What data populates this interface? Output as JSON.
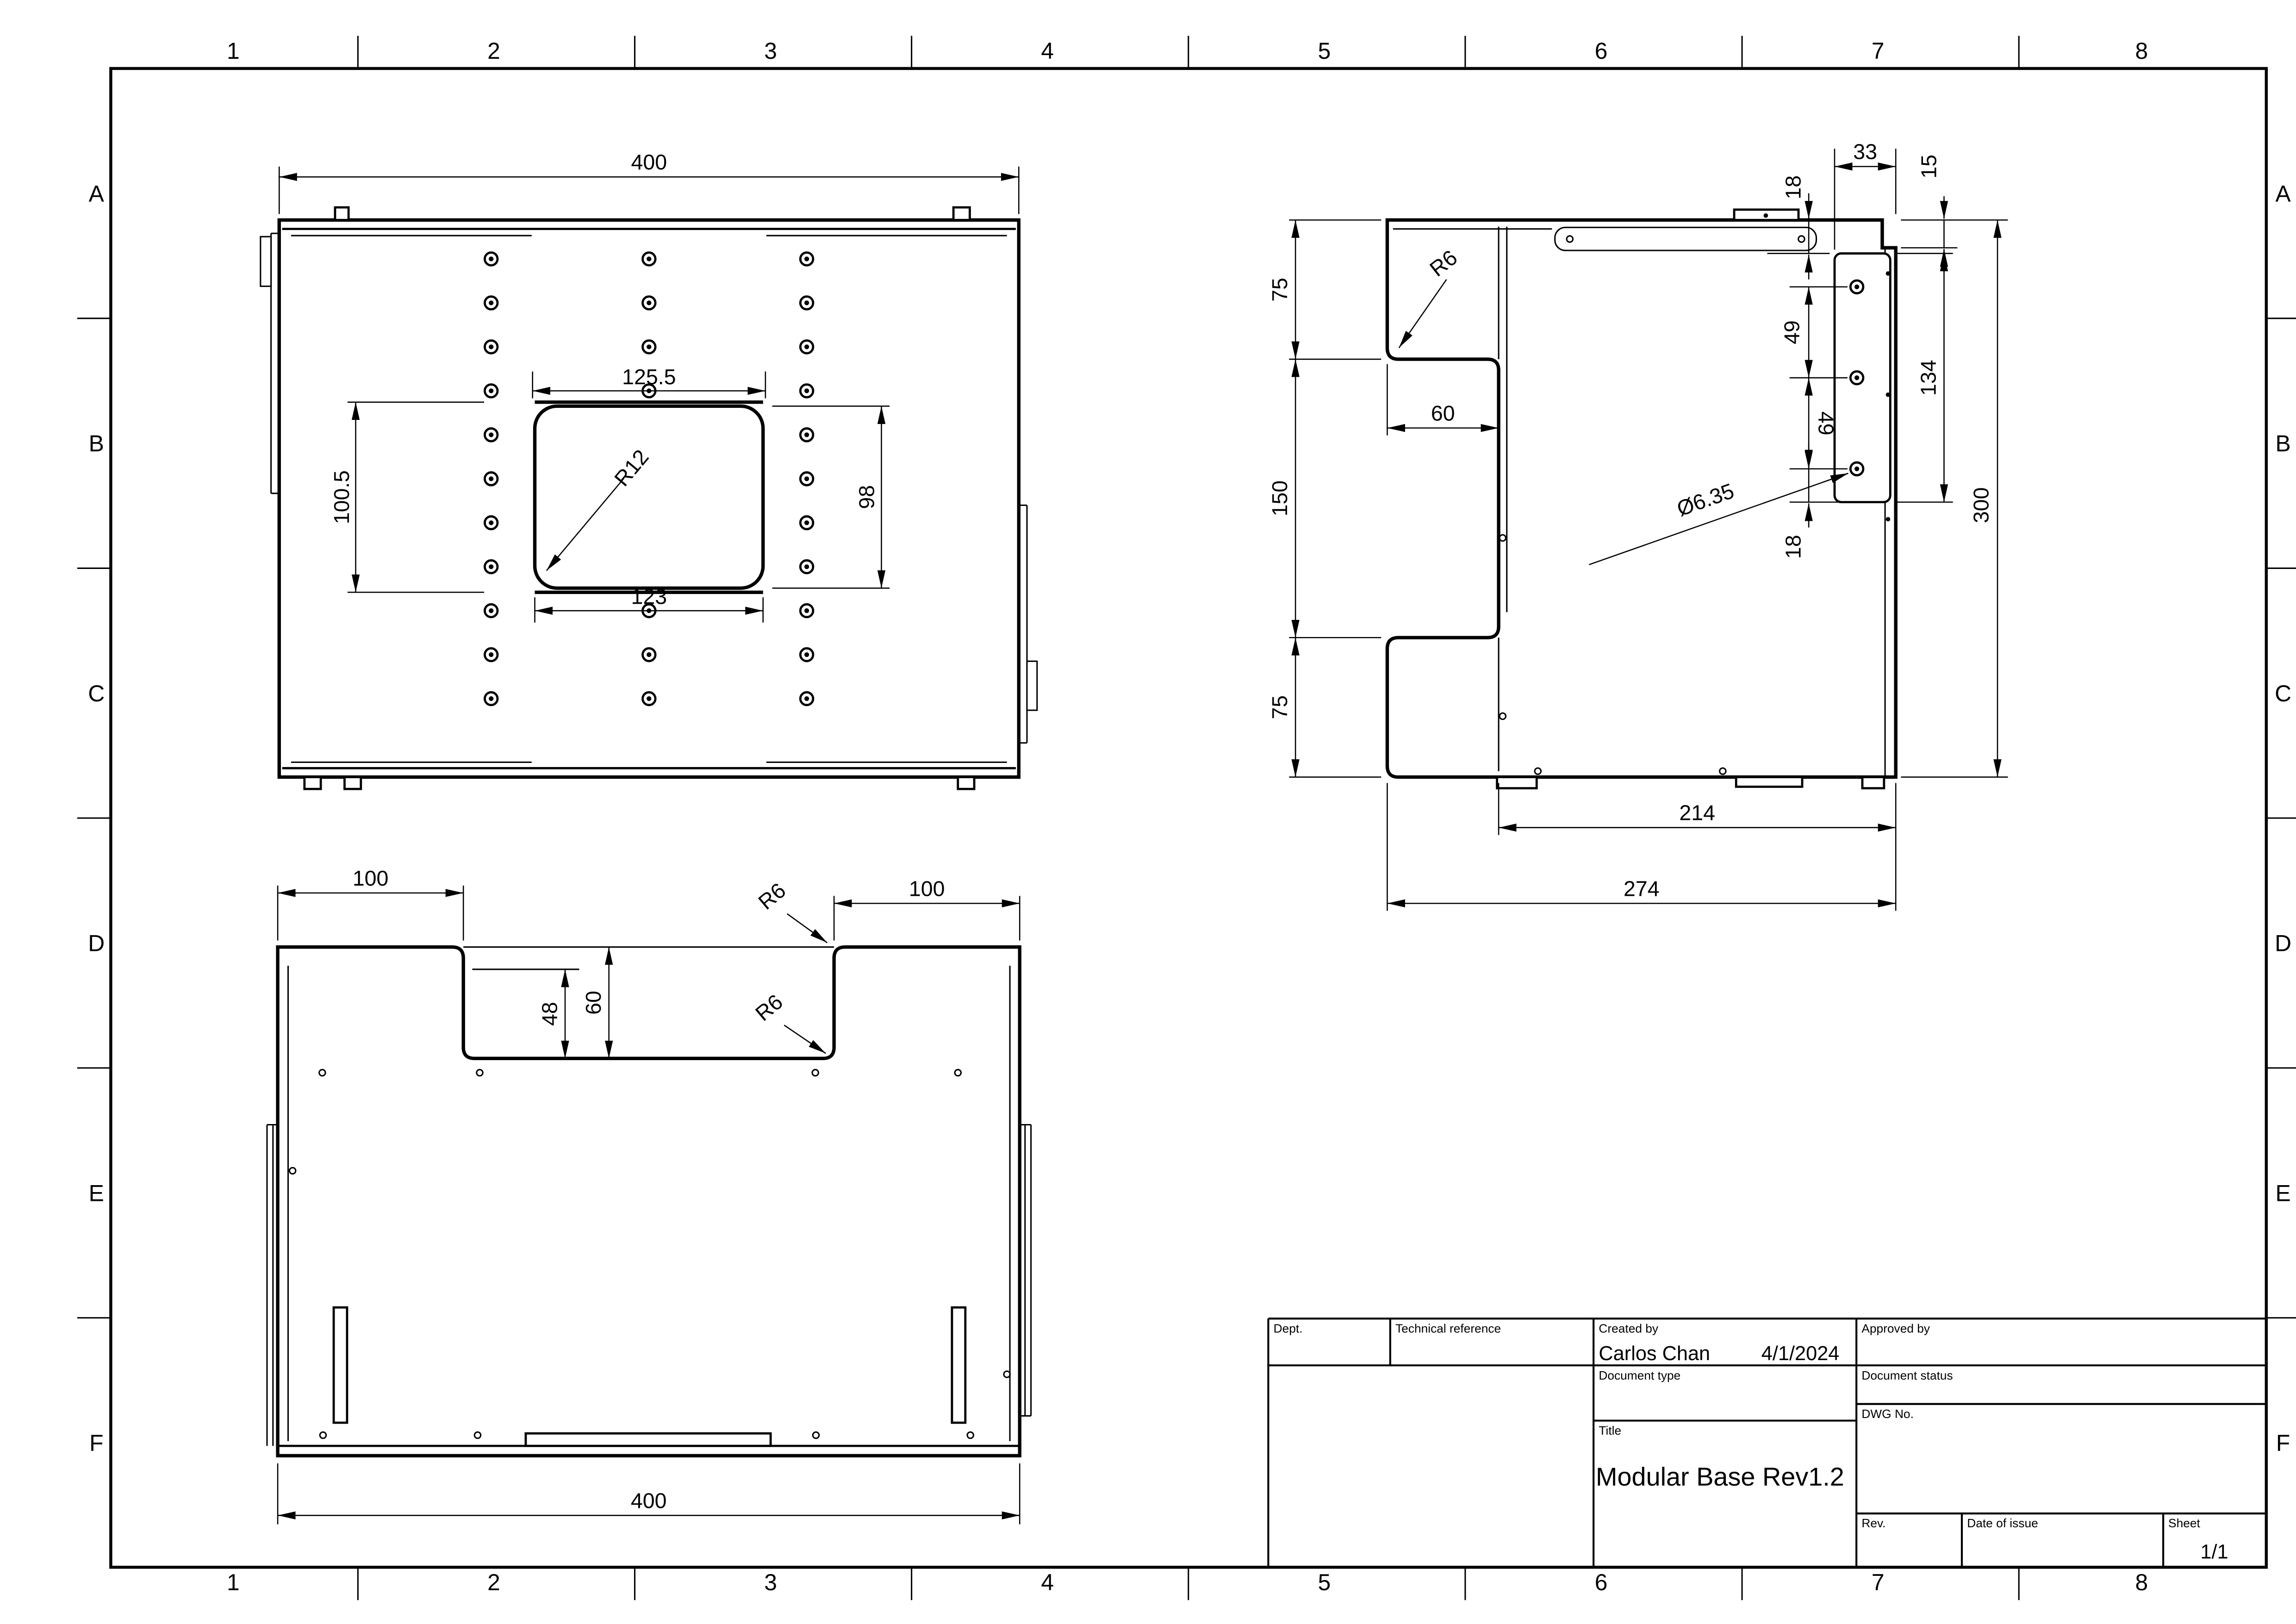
{
  "sheet": {
    "columns": [
      "1",
      "2",
      "3",
      "4",
      "5",
      "6",
      "7",
      "8"
    ],
    "rows": [
      "A",
      "B",
      "C",
      "D",
      "E",
      "F"
    ]
  },
  "title_block": {
    "dept_label": "Dept.",
    "technical_reference_label": "Technical reference",
    "created_by_label": "Created by",
    "created_by": "Carlos Chan",
    "created_date": "4/1/2024",
    "approved_by_label": "Approved by",
    "document_type_label": "Document type",
    "document_status_label": "Document status",
    "title_label": "Title",
    "title": "Modular Base Rev1.2",
    "dwg_no_label": "DWG No.",
    "rev_label": "Rev.",
    "date_of_issue_label": "Date of issue",
    "sheet_label": "Sheet",
    "sheet_number": "1/1"
  },
  "views": {
    "top": {
      "dims": {
        "overall_width": "400",
        "hole_pitch": "125.5",
        "opening_height_outer": "100.5",
        "opening_height": "98",
        "opening_width": "123",
        "corner_radius": "R12"
      }
    },
    "side": {
      "dims": {
        "upper_height": "75",
        "middle_height": "150",
        "lower_height": "75",
        "notch_depth": "60",
        "notch_radius": "R6",
        "flange_offset": "18",
        "bracket_width": "33",
        "step_height": "15",
        "hole_pitch_upper": "49",
        "hole_pitch_lower": "49",
        "bracket_height": "134",
        "overall_height": "300",
        "hole_diameter": "Ø6.35",
        "hole_edge_offset": "18",
        "base_width": "214",
        "overall_width": "274"
      }
    },
    "bottom": {
      "dims": {
        "left_shoulder": "100",
        "right_shoulder": "100",
        "notch_inner_height": "48",
        "notch_depth": "60",
        "radius_upper": "R6",
        "radius_lower": "R6",
        "overall_width": "400"
      }
    }
  }
}
